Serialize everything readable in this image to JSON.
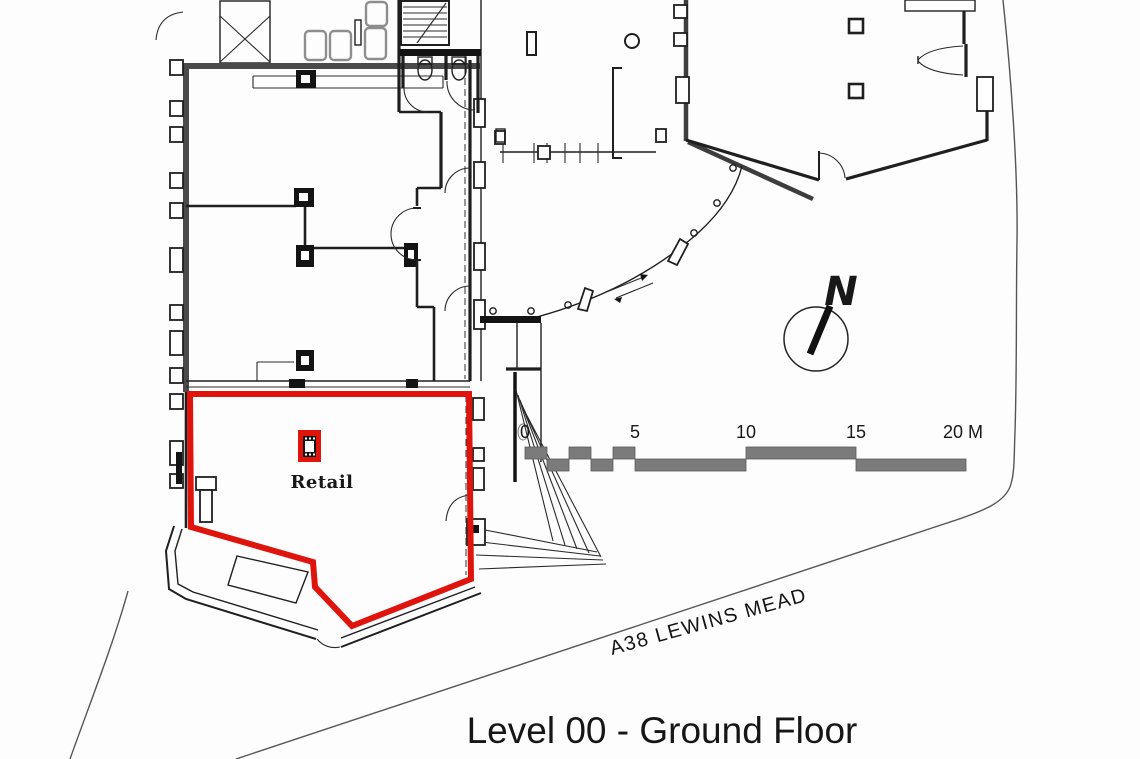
{
  "drawing": {
    "title": "Level 00 - Ground Floor",
    "road_label": "A38 LEWINS MEAD",
    "unit_label": "Retail",
    "north_label": "N"
  },
  "scale_bar": {
    "labels": [
      "0",
      "5",
      "10",
      "15",
      "20 M"
    ],
    "unit": "M"
  },
  "icons": {
    "north_arrow": "north-arrow-compass",
    "retail_column": "column-symbol"
  },
  "colors": {
    "highlight": "#df140c",
    "boundary": "#555555",
    "scale-gray": "#7b7b7b",
    "ink": "#1f1f1f",
    "paper": "#fdfdfd"
  }
}
